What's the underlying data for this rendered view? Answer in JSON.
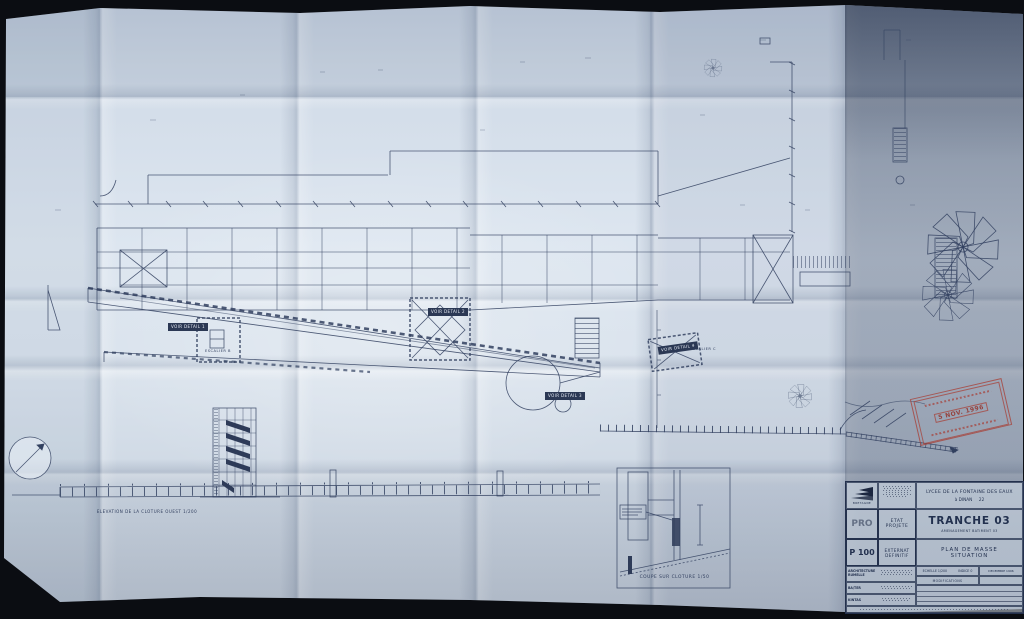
{
  "labels": {
    "detail_1": "VOIR DETAIL 1",
    "detail_2": "VOIR DETAIL 2",
    "detail_3": "VOIR DETAIL 3",
    "detail_4": "VOIR DETAIL 4",
    "escalier_b": "ESCALIER B",
    "escalier_c": "ESCALIER C",
    "elevation_caption": "ELEVATION DE LA CLOTURE OUEST  1/200",
    "coupe_caption": "COUPE SUR CLOTURE  1/50"
  },
  "stamp": {
    "date": "5 NOV. 1996"
  },
  "title_block": {
    "logo": "BRETAGNE",
    "project": {
      "line1": "LYCEE DE LA FONTAINE DES EAUX",
      "line2": "à DINAN",
      "dept": "22"
    },
    "tranche": "TRANCHE 03",
    "operation": "AMENAGEMENT BATIMENT 03",
    "drawing": {
      "line1": "PLAN DE MASSE",
      "line2": "SITUATION"
    },
    "phase": {
      "code": "PRO",
      "label1": "ETAT",
      "label2": "PROJETE"
    },
    "number": {
      "code": "P 100",
      "label1": "EXTERNAT",
      "label2": "DEFINITIF"
    },
    "meta": {
      "echelle": "ECHELLE 1/200",
      "indice": "INDICE 0",
      "date": "DECEMBRE 1996",
      "modifications": "MODIFICATIONS"
    },
    "consultants": [
      {
        "line1": "ARCHITECTURE",
        "line2": "RUMELLE"
      },
      {
        "line1": "BA/TER",
        "line2": ""
      },
      {
        "line1": "KINTAS",
        "line2": ""
      }
    ]
  },
  "colors": {
    "ink": "#31405f",
    "stamp_red": "#a8433c",
    "paper": "#d6dfea"
  }
}
